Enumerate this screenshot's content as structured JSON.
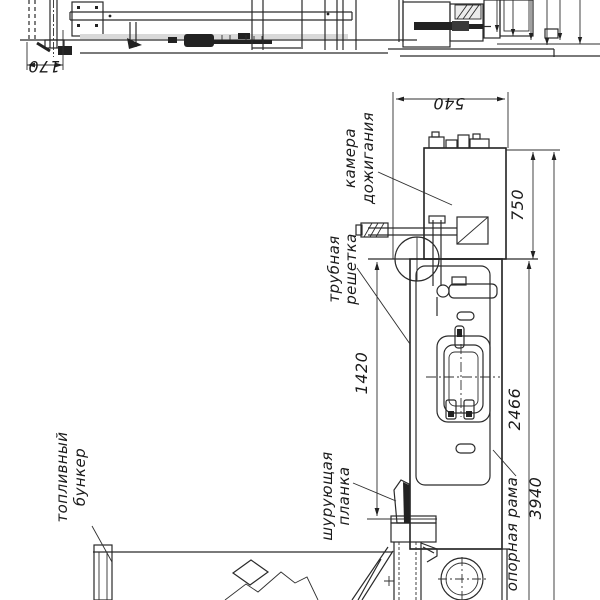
{
  "drawing": {
    "background": "#ffffff",
    "line_color": "#2a2a2a",
    "labels": {
      "kamera": {
        "line1": "камера",
        "line2": "дожигания"
      },
      "trubnaya": {
        "line1": "трубная",
        "line2": "решетка"
      },
      "toplivny": {
        "line1": "топливный",
        "line2": "бункер"
      },
      "shuruyushchaya": {
        "line1": "шурующая",
        "line2": "планка"
      },
      "opornaya": {
        "text": "опорная рама"
      }
    },
    "dimensions": {
      "d170": "170",
      "d540": "540",
      "d750": "750",
      "d1420": "1420",
      "d2466": "2466",
      "d3940": "3940"
    }
  }
}
